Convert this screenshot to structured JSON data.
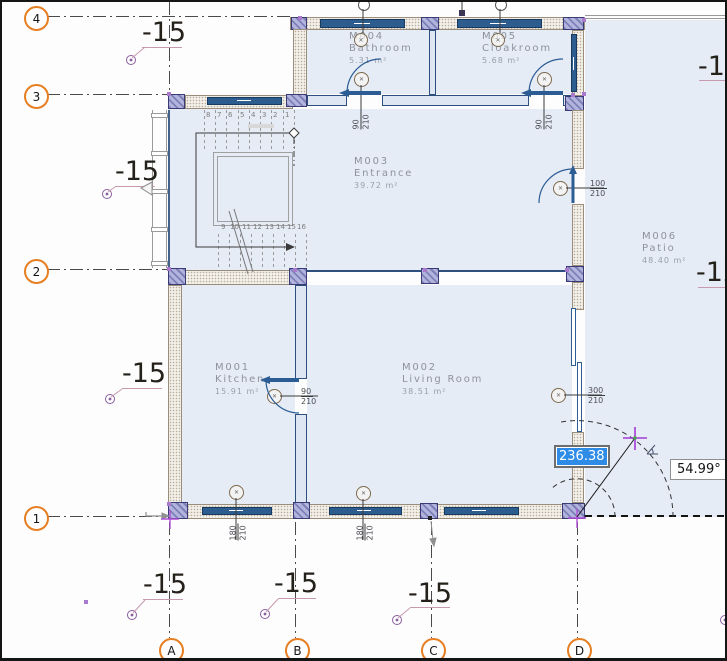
{
  "view": {
    "type": "cad-floor-plan-viewport"
  },
  "grids": {
    "rows": [
      {
        "label": "4"
      },
      {
        "label": "3"
      },
      {
        "label": "2"
      },
      {
        "label": "1"
      }
    ],
    "cols": [
      {
        "label": "A"
      },
      {
        "label": "B"
      },
      {
        "label": "C"
      },
      {
        "label": "D"
      }
    ]
  },
  "elevations": {
    "items": [
      {
        "label": "-15"
      },
      {
        "label": "-15"
      },
      {
        "label": "-15"
      },
      {
        "label": "-15"
      },
      {
        "label": "-15"
      },
      {
        "label": "-15"
      },
      {
        "label": "-13"
      },
      {
        "label": "-12"
      }
    ]
  },
  "rooms": [
    {
      "id": "M001",
      "name": "Kitchen",
      "area": "15.91 m²"
    },
    {
      "id": "M002",
      "name": "Living Room",
      "area": "38.51 m²"
    },
    {
      "id": "M003",
      "name": "Entrance",
      "area": "39.72 m²"
    },
    {
      "id": "M004",
      "name": "Bathroom",
      "area": "5.31 m²"
    },
    {
      "id": "M005",
      "name": "Cloakroom",
      "area": "5.68 m²"
    },
    {
      "id": "M006",
      "name": "Patio",
      "area": "48.40 m²"
    }
  ],
  "door_annotations": [
    {
      "name": "bathroom-door",
      "w": "90",
      "h": "210"
    },
    {
      "name": "cloakroom-door",
      "w": "90",
      "h": "210"
    },
    {
      "name": "entrance-patio-door",
      "w": "100",
      "h": "210"
    },
    {
      "name": "kitchen-door",
      "w": "90",
      "h": "210"
    },
    {
      "name": "living-room-door",
      "w": "300",
      "h": "210"
    },
    {
      "name": "window-a-b",
      "w": "180",
      "h": "210"
    },
    {
      "name": "window-b-c",
      "w": "180",
      "h": "210"
    }
  ],
  "stairs": {
    "upper": [
      "8",
      "7",
      "6",
      "5",
      "4",
      "3",
      "2",
      "1"
    ],
    "lower": [
      "9",
      "10",
      "11",
      "12",
      "13",
      "14",
      "15",
      "16"
    ]
  },
  "measurements": {
    "length_input": "236.38",
    "angle": "54.99°"
  },
  "colors": {
    "room_fill": "#e6ecf6",
    "window": "#2d5d8f",
    "grid_bubble": "#e67e22",
    "selection": "#2e8ce6",
    "cursor": "#a23bd6",
    "leader_pink": "#c79ab0"
  }
}
